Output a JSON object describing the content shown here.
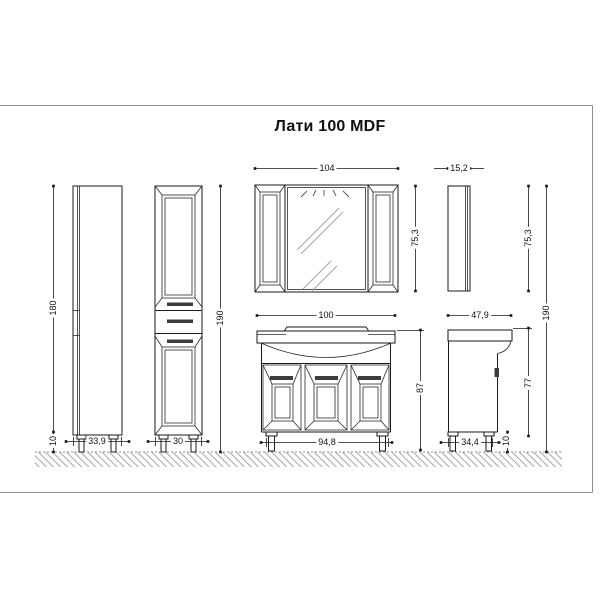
{
  "title": "Лати 100 MDF",
  "colors": {
    "background": "#ffffff",
    "line": "#1a1a1a",
    "frame_border": "#909090",
    "hatch": "#8f8f8f",
    "handle": "#3c3c3c"
  },
  "dims": {
    "mirror_width": "104",
    "mirror_depth": "15,2",
    "mirror_height": "75,3",
    "mirror_height_side": "75,3",
    "column_height": "180",
    "column_total_height": "190",
    "column_leg_height": "10",
    "column_side_width": "33,9",
    "column_front_width": "30",
    "vanity_width": "100",
    "vanity_depth": "47,9",
    "vanity_height": "87",
    "vanity_body_height": "77",
    "vanity_leg_height": "10",
    "vanity_base_width": "94,8",
    "vanity_base_depth": "34,4",
    "total_height": "190"
  }
}
